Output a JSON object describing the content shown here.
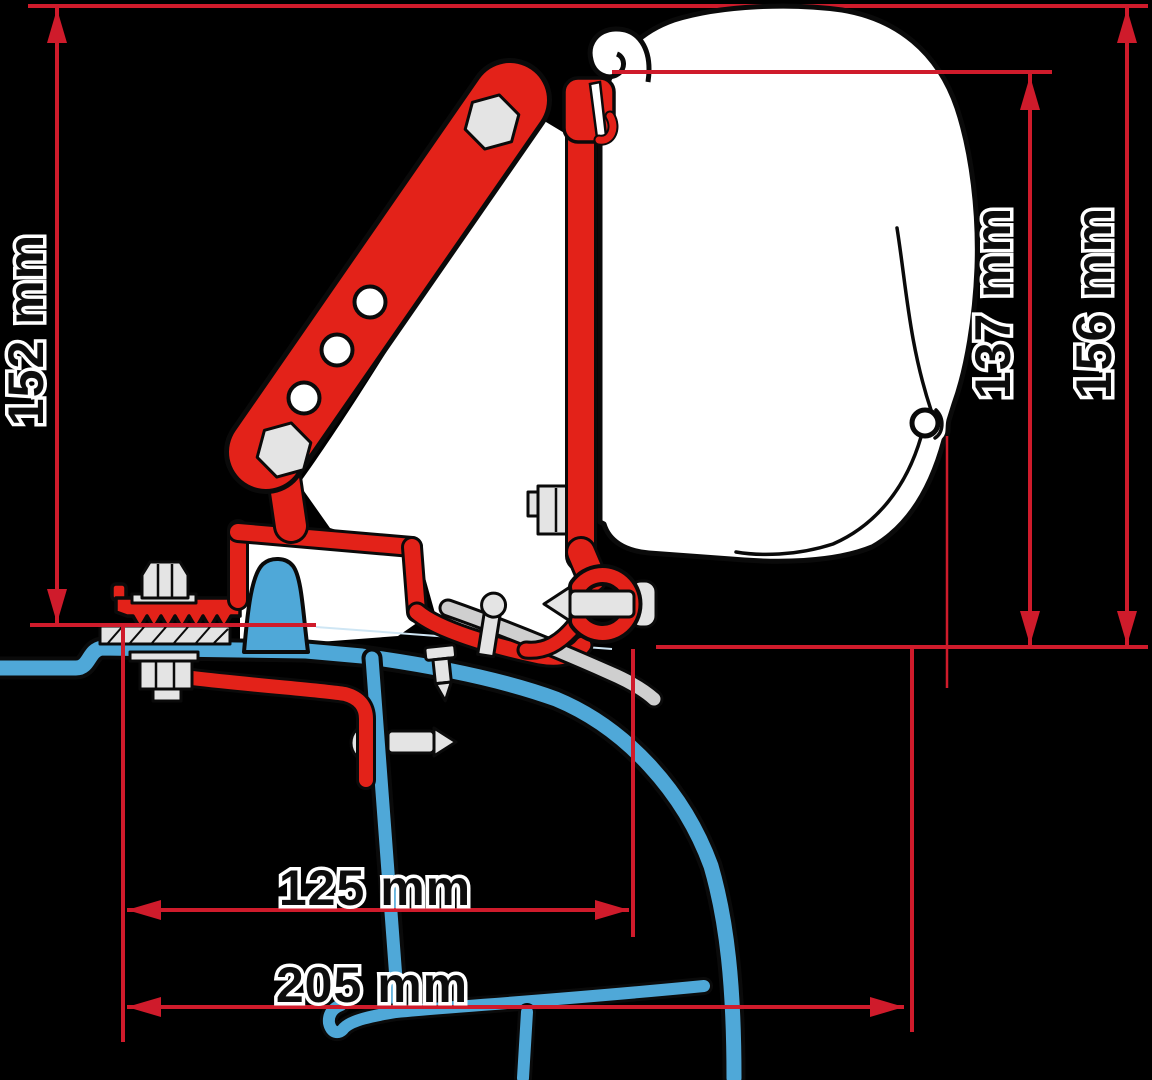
{
  "diagram": {
    "kind": "awning-adapter-bracket-cross-section",
    "dimensions": {
      "bracket_height": {
        "label": "152 mm"
      },
      "case_height": {
        "label": "137 mm"
      },
      "total_height": {
        "label": "156 mm"
      },
      "inner_offset": {
        "label": "125 mm"
      },
      "outer_offset": {
        "label": "205 mm"
      }
    }
  },
  "colors": {
    "background": "#000000",
    "dimension_red": "#cf1b2b",
    "bracket_red": "#e32219",
    "van_blue": "#4fa8d8",
    "hardware_gray": "#e4e4e4",
    "rail_gray": "#cfcfcf",
    "case_white": "#ffffff"
  }
}
